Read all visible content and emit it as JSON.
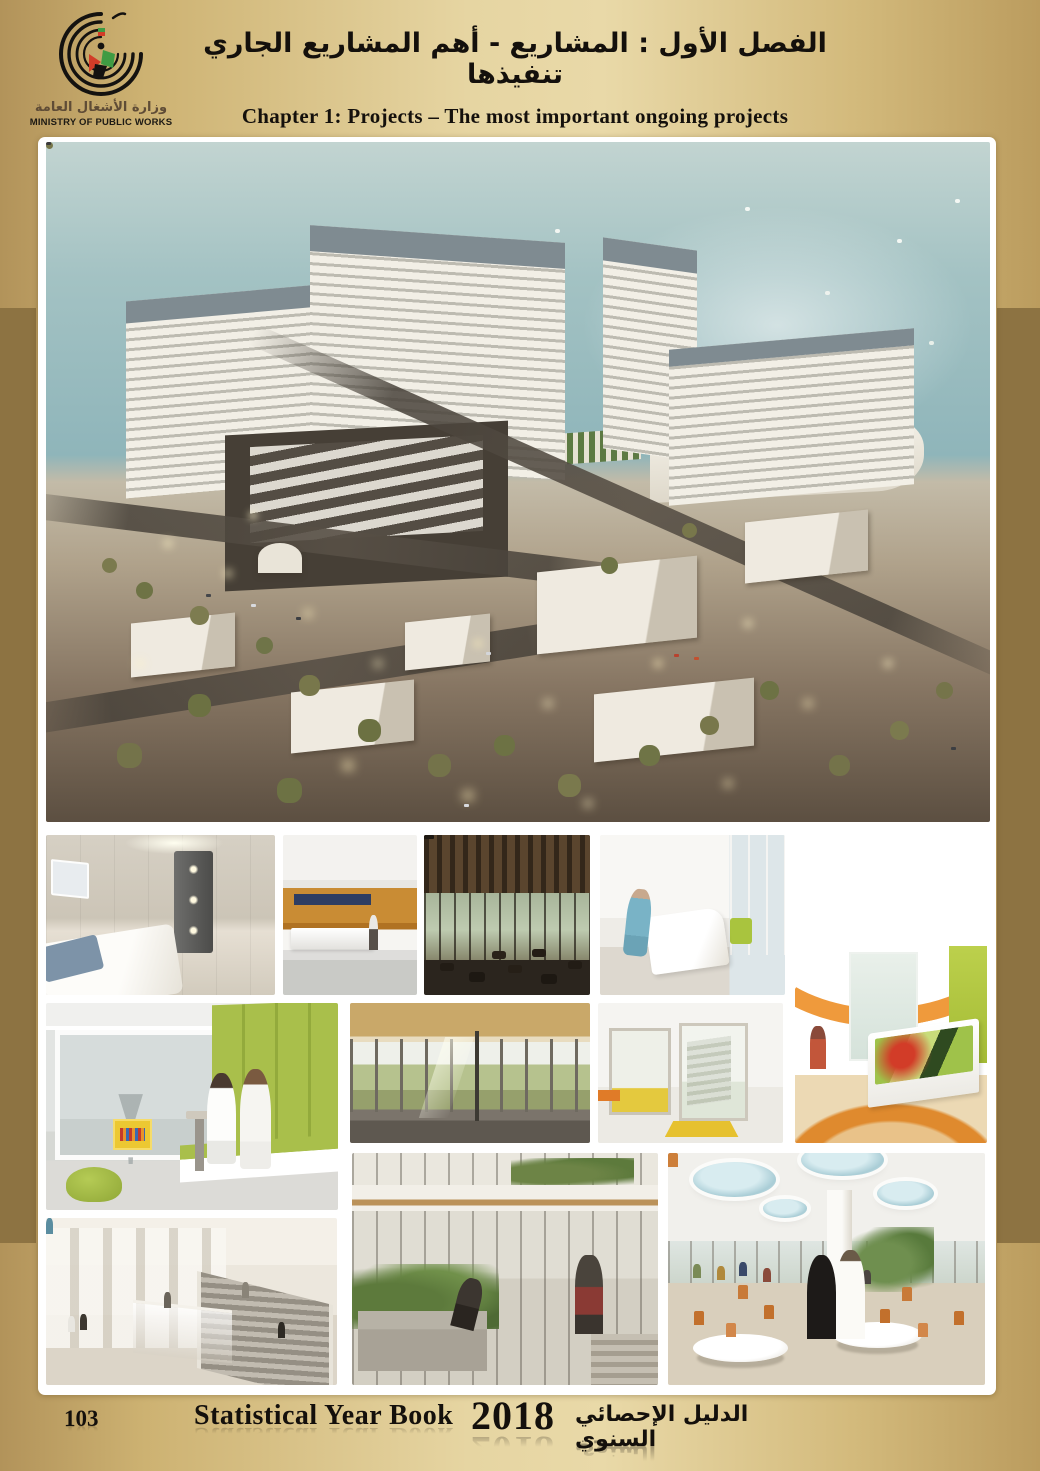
{
  "header": {
    "title_ar": "الفصل الأول : المشاريع - أهم المشاريع الجاري تنفيذها",
    "title_en": "Chapter 1: Projects – The most important ongoing projects"
  },
  "logo": {
    "ministry_ar": "وزارة الأشغال العامة",
    "ministry_en": "MINISTRY OF PUBLIC WORKS"
  },
  "footer": {
    "page_number": "103",
    "book_title": "Statistical Year Book",
    "year": "2018",
    "book_title_ar": "الدليل الإحصائي السنوي"
  },
  "colors": {
    "side_bar_gold": "#8d7342",
    "background_gold_light": "#e9d9a8",
    "background_gold_dark": "#b2935a",
    "panel_white": "#ffffff",
    "text_black": "#14100c"
  },
  "photos": [
    {
      "id": "aerial",
      "subject": "hospital campus aerial rendering at dusk by the sea"
    },
    {
      "id": "patient-room",
      "subject": "patient room with bed and lit wall panel"
    },
    {
      "id": "reception-lobby",
      "subject": "lobby with orange wood wall and reception desk"
    },
    {
      "id": "cafe-terrace",
      "subject": "dark wood cafe seating area with glass walls"
    },
    {
      "id": "patient-room-nurse",
      "subject": "bright patient room with nurse at bedside"
    },
    {
      "id": "childrens-reception",
      "subject": "reception with curved orange soffit and flower desk"
    },
    {
      "id": "staff-window-seat",
      "subject": "two nurses on green window bench"
    },
    {
      "id": "glass-corridor",
      "subject": "glazed corridor with wood ceiling and lawn view"
    },
    {
      "id": "yellow-corridor",
      "subject": "white corridor with yellow floor accents"
    },
    {
      "id": "escalator-atrium",
      "subject": "atrium with columns and escalators"
    },
    {
      "id": "garden-courtyard",
      "subject": "indoor landscaped courtyard with people"
    },
    {
      "id": "cafeteria",
      "subject": "cafeteria with oval skylights and orange chairs"
    }
  ]
}
